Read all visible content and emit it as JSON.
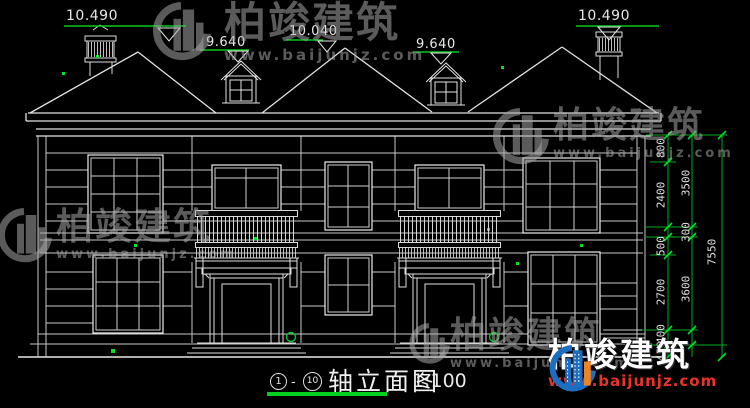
{
  "drawing": {
    "title": {
      "axis_from": "1",
      "axis_to": "10",
      "separator": "-",
      "name": "轴立面图",
      "scale": "1:100"
    },
    "elevations": {
      "left_chimney": "10.490",
      "right_chimney": "10.490",
      "center_ridge": "10.040",
      "dormer_left": "9.640",
      "dormer_right": "9.640"
    },
    "dims_inner": [
      "800",
      "2400",
      "500",
      "2700",
      "400",
      "450"
    ],
    "dims_mid": [
      "3500",
      "300",
      "3600"
    ],
    "dim_total": "7550"
  },
  "watermark": {
    "brand": "柏竣建筑",
    "url": "www.baijunjz.com"
  },
  "colors": {
    "line": "#c9c9c9",
    "green": "#00b41e",
    "dim_text": "#e2e2e2",
    "logo_blue": "#1d6ec0",
    "logo_orange": "#f08223",
    "url_red": "#e8332a"
  }
}
